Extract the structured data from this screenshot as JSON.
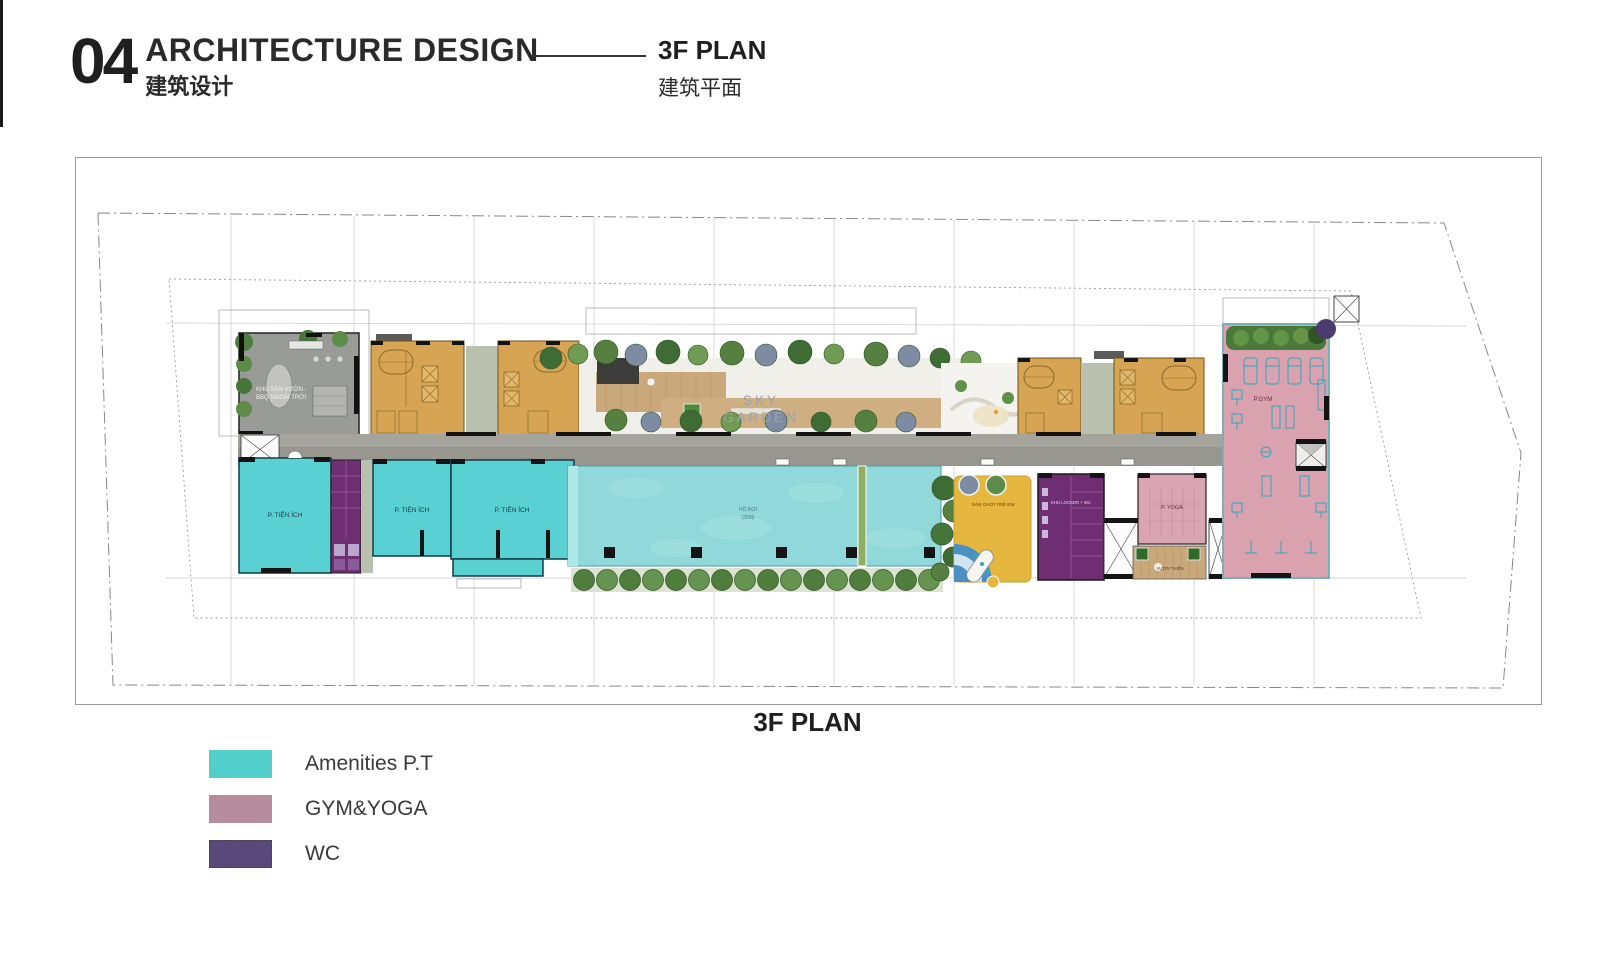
{
  "header": {
    "section_number": "04",
    "title": "ARCHITECTURE DESIGN",
    "title_zh": "建筑设计",
    "page_title": "3F PLAN",
    "page_title_zh": "建筑平面"
  },
  "plan": {
    "caption": "3F PLAN",
    "labels": {
      "bbq_line1": "KHU SÂN VƯỜN -",
      "bbq_line2": "BBQ NGOÀI TRỜI",
      "sky_line1": "SKY",
      "sky_line2": "GARDEN",
      "amenity": "P. TIỆN ÍCH",
      "pool_line1": "HỒ BƠI",
      "pool_line2": "(25M)",
      "playground": "SÂN CHƠI TRẺ EM",
      "locker": "KHU LOCKER + WC",
      "yoga": "P. YOGA",
      "meditation": "VƯỜN THIỀN",
      "gym": "P.GYM"
    }
  },
  "legend": {
    "items": [
      {
        "label": "Amenities P.T",
        "color": "#52cfcb"
      },
      {
        "label": "GYM&YOGA",
        "color": "#b78c9d"
      },
      {
        "label": "WC",
        "color": "#59497b"
      }
    ]
  },
  "colors": {
    "pool": "#90d8da",
    "residential_core": "#d6a452",
    "corridor": "#97978f",
    "playground": "#e5b73e",
    "wc_room": "#6f2e71",
    "gym_room": "#daa2ae",
    "wood_deck": "#c9a87c",
    "tree_green": "#4e7d3c"
  }
}
